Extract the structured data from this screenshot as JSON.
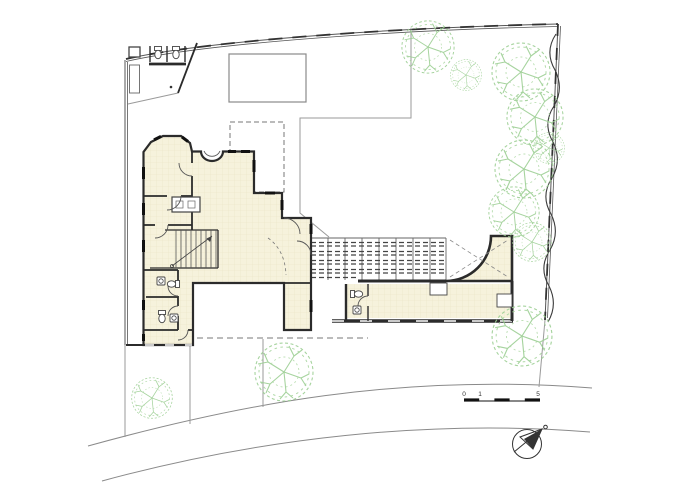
{
  "drawing": {
    "type": "architectural-site-plan",
    "scale_bar": {
      "labels": [
        "0",
        "1",
        "5"
      ]
    }
  },
  "palette": {
    "paper": "#ffffff",
    "wall": "#2b2b2b",
    "boundary": "#555555",
    "thin_line": "#9a9a9a",
    "road": "#8a8a8a",
    "cream": "#f6f2dc",
    "cream_grid": "#eae3c6",
    "tree_green": "#9ccf93",
    "pergola": "#444444"
  },
  "trees": [
    {
      "cx": 428,
      "cy": 47,
      "r": 27
    },
    {
      "cx": 466,
      "cy": 75,
      "r": 16
    },
    {
      "cx": 521,
      "cy": 72,
      "r": 30
    },
    {
      "cx": 535,
      "cy": 117,
      "r": 29
    },
    {
      "cx": 549,
      "cy": 148,
      "r": 16
    },
    {
      "cx": 524,
      "cy": 169,
      "r": 30
    },
    {
      "cx": 514,
      "cy": 212,
      "r": 26
    },
    {
      "cx": 532,
      "cy": 242,
      "r": 20
    },
    {
      "cx": 522,
      "cy": 336,
      "r": 31
    },
    {
      "cx": 284,
      "cy": 372,
      "r": 30
    },
    {
      "cx": 152,
      "cy": 398,
      "r": 21
    }
  ]
}
